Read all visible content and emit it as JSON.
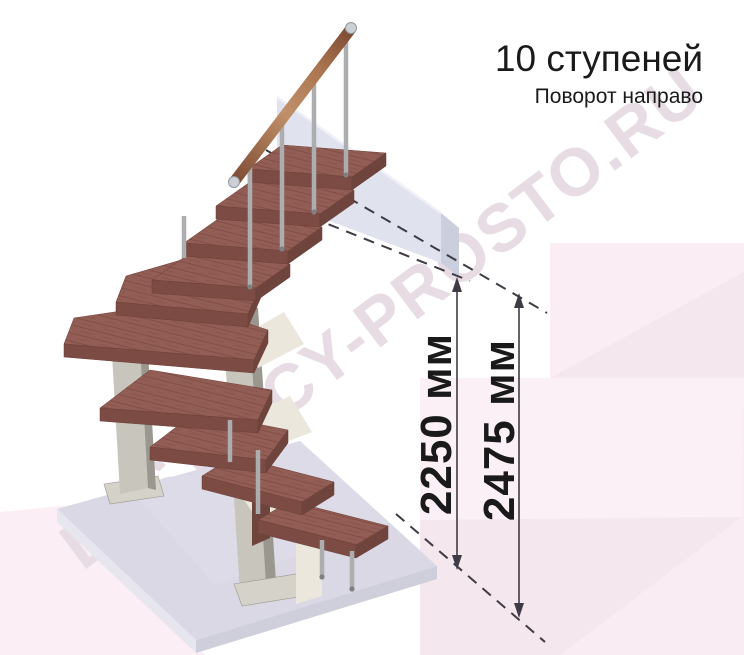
{
  "title": {
    "steps": "10 ступеней",
    "turn": "Поворот направо"
  },
  "dimensions": {
    "to_top_tread": "2250 мм",
    "to_floor_level": "2475 мм"
  },
  "watermark": "LESTNICY-PROSTO.RU",
  "colors": {
    "ink": "#1a1a1a",
    "dim_line": "#3f3b44",
    "watermark": "#e7dce3",
    "tread_top": "#915d54",
    "tread_grain": "#7c4b44",
    "tread_front": "#7c4b43",
    "tread_side": "#6f443d",
    "rail_light": "#c0906a",
    "rail_mid": "#a9744f",
    "rail_dark": "#7d4b33",
    "metal": "#abadaf",
    "metal_dark": "#7e8083",
    "chrome_cap": "#ccd0d5",
    "column": "#c8c5bc",
    "column_dark": "#9a978e",
    "cream": "#ebe7dd",
    "slab_top": "#d9d8e4",
    "slab_left": "#e7e6ef",
    "slab_right": "#cfcedb",
    "panel": "#e0e2ed",
    "panel_side": "#cbcedd",
    "panel_edge": "#f0f1f7",
    "pink_block": "#faeef4",
    "pink_deep": "#f5e7ee",
    "pink_bottom": "#f9edf3",
    "pink_light": "#fbf0f6",
    "pink_left": "#fbeff5"
  }
}
